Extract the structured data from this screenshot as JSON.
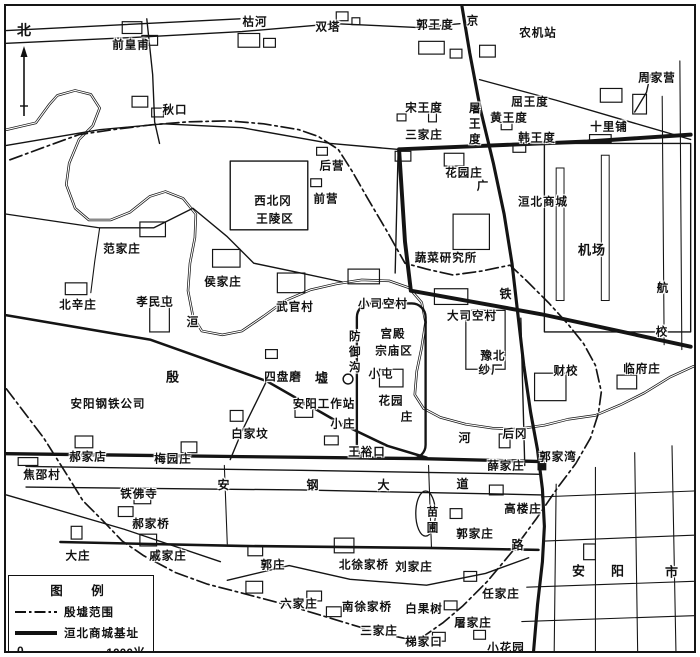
{
  "colors": {
    "ink": "#141414",
    "paper": "#ffffff"
  },
  "north": {
    "label": "北"
  },
  "legend": {
    "title": "图　例",
    "items": [
      {
        "style": "dashdot",
        "label": "殷墟范围"
      },
      {
        "style": "solid",
        "label": "洹北商城基址"
      }
    ],
    "scale": {
      "start": "0",
      "end": "1000米"
    }
  },
  "map": {
    "labels": [
      {
        "t": "前皇甫",
        "x": 125,
        "y": 40
      },
      {
        "t": "枯河",
        "x": 249,
        "y": 17
      },
      {
        "t": "双塔",
        "x": 322,
        "y": 22
      },
      {
        "t": "郭王度",
        "x": 429,
        "y": 20
      },
      {
        "t": "京",
        "x": 467,
        "y": 16
      },
      {
        "t": "农机站",
        "x": 532,
        "y": 28
      },
      {
        "t": "周家营",
        "x": 651,
        "y": 73
      },
      {
        "t": "秋口",
        "x": 169,
        "y": 105
      },
      {
        "t": "宋王度",
        "x": 418,
        "y": 103
      },
      {
        "t": "屠王度",
        "x": 467,
        "y": 119,
        "v": 1
      },
      {
        "t": "屈王度",
        "x": 524,
        "y": 97
      },
      {
        "t": "黄王度",
        "x": 503,
        "y": 113
      },
      {
        "t": "韩王度",
        "x": 531,
        "y": 133
      },
      {
        "t": "三家庄",
        "x": 418,
        "y": 130
      },
      {
        "t": "十里铺",
        "x": 603,
        "y": 122
      },
      {
        "t": "后营",
        "x": 326,
        "y": 161
      },
      {
        "t": "前营",
        "x": 320,
        "y": 194
      },
      {
        "t": "西北冈",
        "x": 267,
        "y": 196
      },
      {
        "t": "王陵区",
        "x": 269,
        "y": 214
      },
      {
        "t": "花园庄",
        "x": 458,
        "y": 168
      },
      {
        "t": "广",
        "x": 477,
        "y": 181
      },
      {
        "t": "洹北商城",
        "x": 537,
        "y": 197
      },
      {
        "t": "机场",
        "x": 586,
        "y": 244,
        "s": 13
      },
      {
        "t": "航",
        "x": 657,
        "y": 283
      },
      {
        "t": "校",
        "x": 656,
        "y": 327
      },
      {
        "t": "范家庄",
        "x": 116,
        "y": 244
      },
      {
        "t": "侯家庄",
        "x": 217,
        "y": 277
      },
      {
        "t": "武官村",
        "x": 289,
        "y": 302
      },
      {
        "t": "孝民屯",
        "x": 149,
        "y": 297
      },
      {
        "t": "北辛庄",
        "x": 72,
        "y": 300
      },
      {
        "t": "洹",
        "x": 187,
        "y": 316,
        "s": 12
      },
      {
        "t": "小司空村",
        "x": 377,
        "y": 299
      },
      {
        "t": "大司空村",
        "x": 466,
        "y": 311
      },
      {
        "t": "铁",
        "x": 500,
        "y": 288,
        "s": 12
      },
      {
        "t": "蔬菜研究所",
        "x": 440,
        "y": 253
      },
      {
        "t": "宫殿",
        "x": 387,
        "y": 329
      },
      {
        "t": "宗庙区",
        "x": 388,
        "y": 346
      },
      {
        "t": "防御沟",
        "x": 347,
        "y": 347,
        "v": 1
      },
      {
        "t": "小屯",
        "x": 375,
        "y": 369
      },
      {
        "t": "豫北",
        "x": 487,
        "y": 351
      },
      {
        "t": "纱厂",
        "x": 485,
        "y": 365
      },
      {
        "t": "财校",
        "x": 560,
        "y": 366
      },
      {
        "t": "临府庄",
        "x": 636,
        "y": 364
      },
      {
        "t": "殷",
        "x": 167,
        "y": 371,
        "s": 13
      },
      {
        "t": "墟",
        "x": 316,
        "y": 372,
        "s": 13
      },
      {
        "t": "四盘磨",
        "x": 277,
        "y": 372
      },
      {
        "t": "安阳钢铁公司",
        "x": 102,
        "y": 399
      },
      {
        "t": "安阳工作站",
        "x": 318,
        "y": 399
      },
      {
        "t": "花园",
        "x": 385,
        "y": 396
      },
      {
        "t": "庄",
        "x": 401,
        "y": 412
      },
      {
        "t": "小庄",
        "x": 337,
        "y": 419
      },
      {
        "t": "白家坟",
        "x": 244,
        "y": 429
      },
      {
        "t": "王裕口",
        "x": 361,
        "y": 447
      },
      {
        "t": "河",
        "x": 459,
        "y": 432,
        "s": 12
      },
      {
        "t": "后冈",
        "x": 509,
        "y": 429
      },
      {
        "t": "郭家湾",
        "x": 552,
        "y": 452
      },
      {
        "t": "薛家庄",
        "x": 500,
        "y": 461
      },
      {
        "t": "郝家店",
        "x": 82,
        "y": 452
      },
      {
        "t": "梅园庄",
        "x": 167,
        "y": 454
      },
      {
        "t": "焦邵村",
        "x": 36,
        "y": 470
      },
      {
        "t": "铁佛寺",
        "x": 133,
        "y": 489
      },
      {
        "t": "郝家桥",
        "x": 145,
        "y": 519
      },
      {
        "t": "大庄",
        "x": 72,
        "y": 551
      },
      {
        "t": "戚家庄",
        "x": 162,
        "y": 551
      },
      {
        "t": "安",
        "x": 218,
        "y": 479,
        "s": 12
      },
      {
        "t": "钢",
        "x": 307,
        "y": 479,
        "s": 12
      },
      {
        "t": "大",
        "x": 378,
        "y": 479,
        "s": 12
      },
      {
        "t": "道",
        "x": 457,
        "y": 478,
        "s": 12
      },
      {
        "t": "苗",
        "x": 427,
        "y": 507
      },
      {
        "t": "圃",
        "x": 427,
        "y": 523
      },
      {
        "t": "郭家庄",
        "x": 469,
        "y": 529
      },
      {
        "t": "高楼庄",
        "x": 517,
        "y": 504
      },
      {
        "t": "路",
        "x": 512,
        "y": 539,
        "s": 12
      },
      {
        "t": "郭庄",
        "x": 267,
        "y": 560
      },
      {
        "t": "北徐家桥",
        "x": 358,
        "y": 560
      },
      {
        "t": "刘家庄",
        "x": 408,
        "y": 562
      },
      {
        "t": "安",
        "x": 573,
        "y": 565,
        "s": 13
      },
      {
        "t": "阳",
        "x": 612,
        "y": 565,
        "s": 13
      },
      {
        "t": "市",
        "x": 666,
        "y": 566,
        "s": 13
      },
      {
        "t": "六家庄",
        "x": 293,
        "y": 599
      },
      {
        "t": "南徐家桥",
        "x": 361,
        "y": 602
      },
      {
        "t": "白果树",
        "x": 418,
        "y": 604
      },
      {
        "t": "三家庄",
        "x": 373,
        "y": 626
      },
      {
        "t": "梯家口",
        "x": 418,
        "y": 637
      },
      {
        "t": "任家庄",
        "x": 495,
        "y": 589
      },
      {
        "t": "屠家庄",
        "x": 467,
        "y": 618
      },
      {
        "t": "小花园",
        "x": 500,
        "y": 643
      }
    ],
    "paths": [
      {
        "n": "huan-river",
        "k": "river",
        "d": "M0,126 L30,119 L44,100 L52,91 L70,86 L86,90 L95,104 L88,122 L74,136 L64,160 L61,182 L70,206 L84,218 L106,218 L126,210 L146,194 L162,189 L180,196 L193,212 L192,236 L187,262 L185,290 L190,316 L199,331 L220,335 L240,331 L262,316 L284,300 L310,289 L336,283 L362,279 L390,280 L410,287 L423,302 L427,322 L423,348 L418,372 L416,396 L425,410 L442,419 L468,426 L495,430 L520,431 L548,427 L572,421 L600,417 L626,406 L650,394 L676,378 L700,367"
      },
      {
        "n": "huan-river-inner",
        "k": "riverin",
        "d": "M0,126 L30,119 L44,100 L52,91 L70,86 L86,90 L95,104 L88,122 L74,136 L64,160 L61,182 L70,206 L84,218 L106,218 L126,210 L146,194 L162,189 L180,196 L193,212 L192,236 L187,262 L185,290 L190,316 L199,331 L220,335 L240,331 L262,316 L284,300 L310,289 L336,283 L362,279 L390,280 L410,287 L423,302 L427,322 L423,348 L418,372 L416,396 L425,410 L442,419 L468,426 L495,430 L520,431 L548,427 L572,421 L600,417 L626,406 L650,394 L676,378 L700,367"
      },
      {
        "n": "yinxu-boundary",
        "k": "dash",
        "d": "M0,390 L38,440 L62,478 L78,504 L98,524 L118,545 L140,560 L172,577 L205,589 L240,598 L278,608 L315,619 L348,629 L378,638 L405,644 L425,642 L445,628 L465,611 L490,586 L515,556 L540,522 L562,490 L580,466 L595,440 L603,415 L606,393 L600,366 L588,344 L572,324 L552,302 L530,280 L513,264 L484,270 L455,274 L428,268 L406,262 L388,230 L368,196 L352,168 L338,146 L318,133 L298,126 L262,120 L226,117 L185,118 L148,121 L108,126 L74,131 L38,144 L0,158"
      },
      {
        "n": "huanbei-wall-north",
        "k": "wall",
        "d": "M400,146 L592,138 L697,131"
      },
      {
        "n": "huanbei-wall-west",
        "k": "wall",
        "d": "M400,146 L406,240 L412,290"
      },
      {
        "n": "huanbei-wall-south",
        "k": "wall",
        "d": "M412,290 L545,314 L697,347"
      },
      {
        "n": "railway",
        "k": "rail",
        "d": "M464,0 L472,48 L483,106 L496,160 L507,212 L515,262 L521,314 L527,366 L534,414 L541,452 L546,492 L548,530 L546,566 L541,610 L537,657"
      },
      {
        "n": "road",
        "k": "road",
        "d": "M0,25 L238,13"
      },
      {
        "n": "road",
        "k": "road",
        "d": "M143,13 L149,70 L151,118 L156,140"
      },
      {
        "n": "road",
        "k": "road",
        "d": "M0,38 L130,32 L240,26 L335,18 L420,22 L462,18"
      },
      {
        "n": "road",
        "k": "road",
        "d": "M0,142 L95,126 L160,120 L240,124 L330,140 L398,146"
      },
      {
        "n": "road",
        "k": "road",
        "d": "M482,75 L560,96 L618,113 L697,136"
      },
      {
        "n": "road",
        "k": "road",
        "d": "M640,108 L652,88 L656,70"
      },
      {
        "n": "road",
        "k": "road",
        "d": "M399,148 L396,272"
      },
      {
        "n": "road",
        "k": "road",
        "d": "M0,212 L95,226 L150,226 L190,206 L225,235 L252,262 L300,272 L342,281"
      },
      {
        "n": "road",
        "k": "thin",
        "d": "M95,226 L90,260 L86,292"
      },
      {
        "n": "road",
        "k": "road2",
        "d": "M0,315 L147,340 L265,382 L340,425 L388,448 L428,460"
      },
      {
        "n": "road",
        "k": "road",
        "d": "M265,382 L240,433 L228,462"
      },
      {
        "n": "road",
        "k": "road",
        "d": "M0,498 L120,533 L218,566"
      },
      {
        "n": "road",
        "k": "road",
        "d": "M225,585 L288,570 L350,584 L428,590 L488,578 L532,562"
      },
      {
        "n": "road",
        "k": "road3",
        "d": "M0,456 L240,459 L420,461 L545,464"
      },
      {
        "n": "road",
        "k": "road2",
        "d": "M55,546 L240,550 L430,552 L542,554"
      },
      {
        "n": "road",
        "k": "road",
        "d": "M20,469 L300,473 L545,477"
      },
      {
        "n": "road",
        "k": "road",
        "d": "M20,490 L300,493 L545,498"
      },
      {
        "n": "road",
        "k": "thin",
        "d": "M222,468 L225,548"
      },
      {
        "n": "road",
        "k": "thin",
        "d": "M430,468 L433,552"
      },
      {
        "n": "road",
        "k": "road",
        "d": "M524,318 L528,468"
      },
      {
        "n": "city-street",
        "k": "thin",
        "d": "M560,487 L558,657"
      },
      {
        "n": "city-street",
        "k": "thin",
        "d": "M600,470 L600,657"
      },
      {
        "n": "city-street",
        "k": "thin",
        "d": "M640,455 L643,657"
      },
      {
        "n": "city-street",
        "k": "thin",
        "d": "M678,448 L682,657"
      },
      {
        "n": "city-street",
        "k": "thin",
        "d": "M545,500 L700,494"
      },
      {
        "n": "city-street",
        "k": "thin",
        "d": "M548,545 L700,539"
      },
      {
        "n": "city-street",
        "k": "thin",
        "d": "M530,592 L700,586"
      },
      {
        "n": "city-street",
        "k": "thin",
        "d": "M525,627 L700,621"
      },
      {
        "n": "field-line",
        "k": "thin",
        "d": "M668,92 L670,345"
      },
      {
        "n": "field-line",
        "k": "thin",
        "d": "M686,56 L688,350"
      },
      {
        "n": "airport-boundary",
        "k": "road",
        "d": "M548,140 L697,140 L697,332 L548,332 Z"
      },
      {
        "n": "royal-cemetery-outline",
        "k": "road",
        "d": "M228,158 L307,158 L307,228 L228,228 Z"
      }
    ],
    "rects": [
      [
        118,
        16,
        20,
        12,
        "b"
      ],
      [
        138,
        30,
        16,
        10,
        "b"
      ],
      [
        236,
        28,
        22,
        14,
        "b"
      ],
      [
        262,
        33,
        12,
        9,
        "b"
      ],
      [
        336,
        6,
        12,
        9,
        "b"
      ],
      [
        352,
        12,
        8,
        7,
        "b"
      ],
      [
        420,
        36,
        26,
        13,
        "b"
      ],
      [
        452,
        44,
        12,
        9,
        "b"
      ],
      [
        482,
        40,
        16,
        12,
        "b"
      ],
      [
        605,
        84,
        22,
        14,
        "b"
      ],
      [
        638,
        90,
        14,
        20,
        "b"
      ],
      [
        128,
        92,
        16,
        11,
        "b"
      ],
      [
        148,
        104,
        12,
        9,
        "b"
      ],
      [
        398,
        110,
        9,
        7,
        "b"
      ],
      [
        430,
        108,
        8,
        10,
        "b"
      ],
      [
        504,
        118,
        11,
        8,
        "b"
      ],
      [
        516,
        140,
        13,
        9,
        "b"
      ],
      [
        396,
        148,
        16,
        10,
        "b"
      ],
      [
        594,
        131,
        22,
        8,
        "b"
      ],
      [
        316,
        144,
        11,
        8,
        "b"
      ],
      [
        310,
        176,
        11,
        8,
        "b"
      ],
      [
        446,
        150,
        20,
        13,
        "b"
      ],
      [
        455,
        212,
        37,
        36,
        "b"
      ],
      [
        136,
        220,
        26,
        15,
        "b"
      ],
      [
        210,
        248,
        28,
        18,
        "b"
      ],
      [
        276,
        272,
        28,
        20,
        "b"
      ],
      [
        146,
        306,
        20,
        26,
        "b"
      ],
      [
        60,
        282,
        22,
        12,
        "b"
      ],
      [
        348,
        268,
        32,
        15,
        "b"
      ],
      [
        436,
        288,
        34,
        16,
        "b"
      ],
      [
        264,
        350,
        12,
        9,
        "b"
      ],
      [
        380,
        370,
        24,
        18,
        "b"
      ],
      [
        294,
        406,
        18,
        13,
        "b"
      ],
      [
        228,
        412,
        13,
        11,
        "b"
      ],
      [
        324,
        438,
        14,
        9,
        "b"
      ],
      [
        502,
        436,
        11,
        14,
        "b"
      ],
      [
        468,
        310,
        40,
        60,
        "b"
      ],
      [
        538,
        374,
        32,
        28,
        "b"
      ],
      [
        622,
        376,
        20,
        14,
        "b"
      ],
      [
        70,
        438,
        18,
        12,
        "b"
      ],
      [
        178,
        444,
        16,
        11,
        "b"
      ],
      [
        12,
        460,
        20,
        8,
        "b"
      ],
      [
        130,
        496,
        17,
        11,
        "b"
      ],
      [
        114,
        510,
        15,
        10,
        "b"
      ],
      [
        66,
        530,
        11,
        13,
        "b"
      ],
      [
        136,
        538,
        17,
        12,
        "b"
      ],
      [
        246,
        550,
        15,
        10,
        "b"
      ],
      [
        334,
        542,
        20,
        15,
        "b"
      ],
      [
        244,
        586,
        17,
        12,
        "b"
      ],
      [
        306,
        596,
        15,
        10,
        "b"
      ],
      [
        326,
        612,
        15,
        10,
        "b"
      ],
      [
        434,
        638,
        13,
        9,
        "b"
      ],
      [
        466,
        576,
        13,
        10,
        "b"
      ],
      [
        492,
        488,
        14,
        10,
        "b"
      ],
      [
        452,
        512,
        12,
        10,
        "b"
      ],
      [
        446,
        606,
        13,
        9,
        "b"
      ],
      [
        476,
        636,
        12,
        9,
        "b"
      ],
      [
        588,
        548,
        12,
        16,
        "b"
      ],
      [
        560,
        165,
        8,
        135,
        "run"
      ],
      [
        606,
        152,
        8,
        148,
        "run"
      ],
      [
        357,
        303,
        70,
        158,
        "moat"
      ],
      [
        541,
        453,
        9,
        20,
        "fill"
      ]
    ],
    "circles": [
      [
        348,
        380,
        5
      ]
    ],
    "ellipses": [
      [
        427,
        517,
        10,
        23
      ]
    ]
  }
}
